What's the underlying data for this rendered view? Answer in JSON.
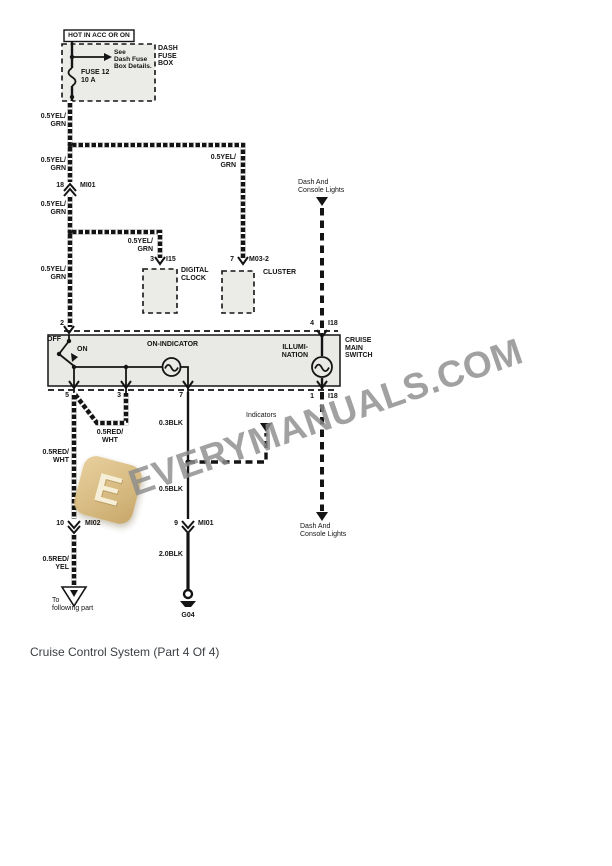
{
  "caption": "Cruise Control System (Part 4 Of 4)",
  "watermark": {
    "text": "EVERYMANUALS.COM",
    "logo_letter": "E"
  },
  "power": {
    "hot": "HOT IN ACC OR ON",
    "box": "DASH\nFUSE\nBOX",
    "note": "See\nDash Fuse\nBox Details.",
    "fuse": "FUSE 12\n10 A"
  },
  "wire_labels": {
    "yelgrn": "0.5YEL/\nGRN",
    "redwht": "0.5RED/\nWHT",
    "redyel": "0.5RED/\nYEL",
    "blk03": "0.3BLK",
    "blk05": "0.5BLK",
    "blk20": "2.0BLK"
  },
  "connectors": {
    "c18_pin": "18",
    "c18_name": "MI01",
    "c10_pin": "10",
    "c10_name": "MI02",
    "c9_pin": "9",
    "c9_name": "MI01",
    "clock_pin": "3",
    "clock_name": "I15",
    "cluster_pin": "7",
    "cluster_name": "M03-2",
    "ground": "G04"
  },
  "components": {
    "clock": "DIGITAL\nCLOCK",
    "cluster": "CLUSTER",
    "switch": "CRUISE\nMAIN\nSWITCH",
    "off": "OFF",
    "on": "ON",
    "on_indicator": "ON-INDICATOR",
    "illumination": "ILLUMI-\nNATION"
  },
  "switch_pins": {
    "p2": "2",
    "p4": "4",
    "p5": "5",
    "p3": "3",
    "p7": "7",
    "p1": "1",
    "i18": "I18"
  },
  "refs": {
    "dash_console": "Dash And\nConsole Lights",
    "indicators": "Indicators",
    "to_following": "To\nfollowing part"
  }
}
